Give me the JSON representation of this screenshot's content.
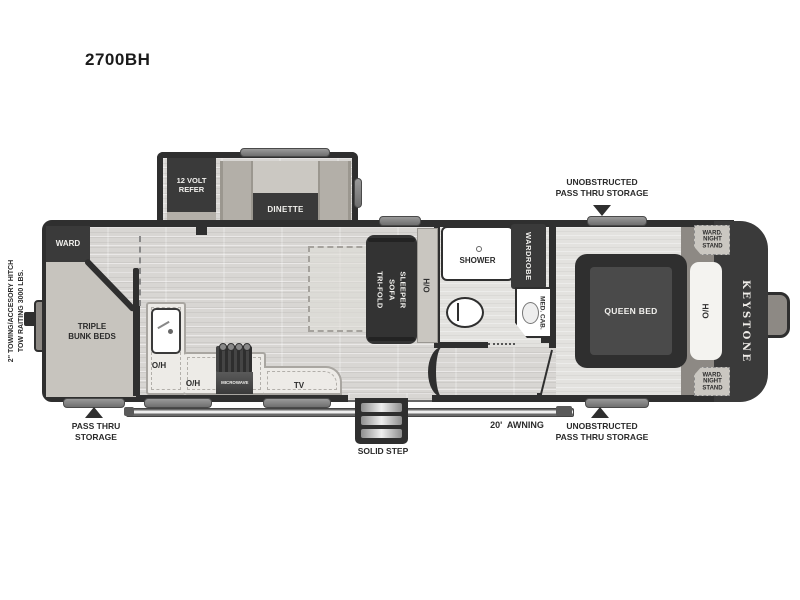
{
  "title": "2700BH",
  "brand": "KEYSTONE",
  "annotations": {
    "tow_hitch": "2\" TOWING/ACCESORY HITCH\nTOW RAITING 3000 LBS.",
    "pass_thru_left": "PASS THRU\nSTORAGE",
    "unobstructed_top": "UNOBSTRUCTED\nPASS THRU STORAGE",
    "unobstructed_bottom": "UNOBSTRUCTED\nPASS THRU STORAGE",
    "awning": "20'  AWNING",
    "solid_step": "SOLID STEP"
  },
  "labels": {
    "ward": "WARD",
    "triple_bunk_beds": "TRIPLE\nBUNK BEDS",
    "refer": "12 VOLT\nREFER",
    "dinette": "DINETTE",
    "sofa_line_left": "TRI-FOLD",
    "sofa_line_right": "SLEEPER SOFA",
    "shower": "SHOWER",
    "wardrobe": "WARDROBE",
    "med_cab": "MED. CAB.",
    "queen_bed": "QUEEN BED",
    "ward_night_stand": "WARD.\nNIGHT\nSTAND",
    "microwave": "MICROWAVE",
    "tv": "TV",
    "overhead": "O/H"
  },
  "colors": {
    "wall": "#2f2f2f",
    "fixture_dark": "#3a3a3a",
    "floor": "#d8d6d3",
    "counter": "#edebe7",
    "bench": "#b3afa8",
    "cap_band": "#8d8984",
    "accent_bar": "#7d7d7d"
  }
}
